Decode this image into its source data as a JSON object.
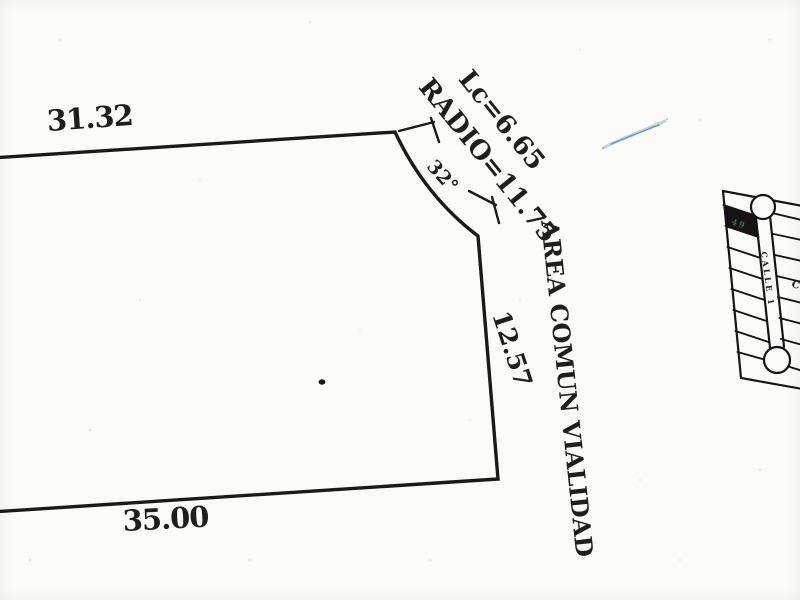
{
  "palette": {
    "paper": "#fcfbf8",
    "ink": "#1b1a17",
    "pen_blue": "#4e87a0",
    "highlight_lot_fill": "#151413",
    "highlight_lot_text": "#51704f"
  },
  "parcel": {
    "top_edge_label": "31.32",
    "bottom_edge_label": "35.00",
    "right_edge_label": "12.57",
    "arc_angle_label": "32°",
    "arc_radius_label": "RADIO=11.75",
    "arc_chord_label": "Lc=6.65",
    "street_area_label": "AREA COMUN VIALIDAD"
  },
  "inset_map": {
    "street_label": "CALLE 1",
    "highlighted_lot_label": "49",
    "partial_right_label": "C"
  }
}
